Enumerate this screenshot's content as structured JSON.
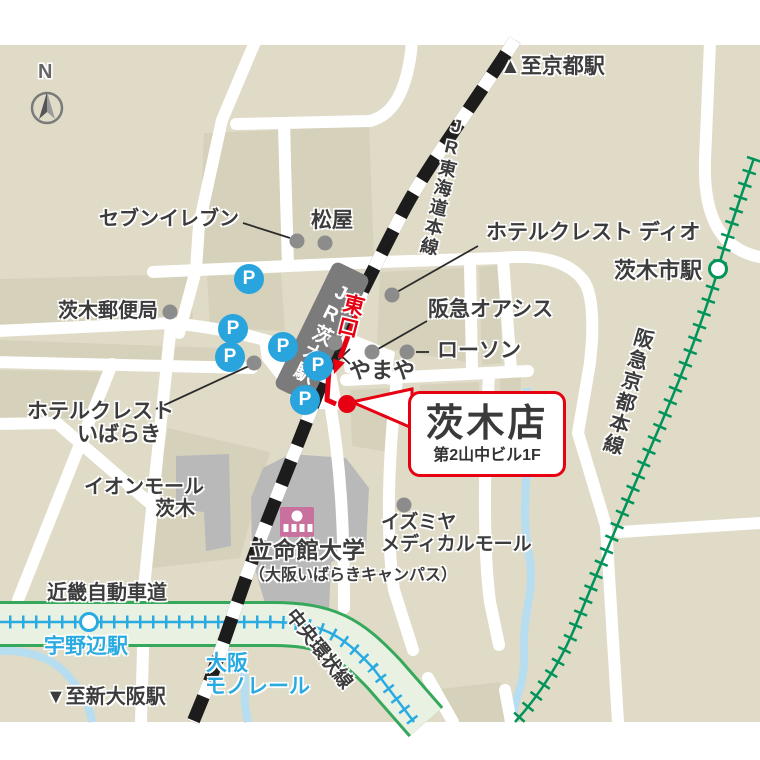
{
  "store": {
    "name": "茨木店",
    "building": "第2山中ビル1F"
  },
  "station": {
    "jr_label": "JR茨木駅",
    "east_exit": "東口"
  },
  "compass": {
    "north_label": "N"
  },
  "colors": {
    "accent_red": "#e60012",
    "parking_blue": "#29a4dd",
    "monorail_cyan": "#29abe2",
    "hankyu_green": "#00935a",
    "expressway_green": "#35a85b",
    "jr_rail_black": "#1c1c1c",
    "road_white": "#ffffff",
    "map_base": "#dfdbc7",
    "map_block": "#d5d1ba",
    "building_gray": "#b9b9b9",
    "university_pink": "#c9719e"
  },
  "map": {
    "parking_letter": "P",
    "parking": [
      {
        "x": 249,
        "y": 279
      },
      {
        "x": 233,
        "y": 329
      },
      {
        "x": 230,
        "y": 357
      },
      {
        "x": 283,
        "y": 347
      },
      {
        "x": 318,
        "y": 366
      },
      {
        "x": 305,
        "y": 400
      }
    ],
    "poi_dots": [
      {
        "name": "seven-eleven-dot",
        "x": 297,
        "y": 241
      },
      {
        "name": "matsuya-dot",
        "x": 325,
        "y": 243
      },
      {
        "name": "post-office-dot",
        "x": 170,
        "y": 312
      },
      {
        "name": "hotel-crest-dio-dot",
        "x": 392,
        "y": 295
      },
      {
        "name": "hankyu-oasis-dot",
        "x": 372,
        "y": 352
      },
      {
        "name": "lawson-dot",
        "x": 407,
        "y": 352
      },
      {
        "name": "yamaya-dot",
        "x": 335,
        "y": 343
      },
      {
        "name": "hotel-crest-ibaraki-dot",
        "x": 254,
        "y": 363
      },
      {
        "name": "izumiya-dot",
        "x": 404,
        "y": 505
      }
    ],
    "station_circles": [
      {
        "name": "ibarakishi-station-circle",
        "x": 718,
        "y": 269,
        "color": "#00935a"
      },
      {
        "name": "unobe-station-circle",
        "x": 89,
        "y": 622,
        "color": "#29abe2"
      }
    ],
    "labels": [
      {
        "id": "to-kyoto",
        "text": "▲至京都駅",
        "x": 500,
        "y": 56,
        "size": 21
      },
      {
        "id": "seven-eleven",
        "text": "セブンイレブン",
        "x": 99,
        "y": 209,
        "size": 20
      },
      {
        "id": "matsuya",
        "text": "松屋",
        "x": 311,
        "y": 210,
        "size": 21
      },
      {
        "id": "hotel-crest-dio",
        "text": "ホテルクレスト ディオ",
        "x": 486,
        "y": 222,
        "size": 21
      },
      {
        "id": "ibarakishi-station",
        "text": "茨木市駅",
        "x": 614,
        "y": 259,
        "size": 22
      },
      {
        "id": "hankyu-oasis",
        "text": "阪急オアシス",
        "x": 428,
        "y": 299,
        "size": 21
      },
      {
        "id": "lawson",
        "text": "ローソン",
        "x": 437,
        "y": 340,
        "size": 21
      },
      {
        "id": "yamaya",
        "text": "やまや",
        "x": 349,
        "y": 359,
        "size": 22
      },
      {
        "id": "post-office",
        "text": "茨木郵便局",
        "x": 58,
        "y": 301,
        "size": 20
      },
      {
        "id": "hotel-crest-ibaraki-1",
        "text": "ホテルクレスト",
        "x": 27,
        "y": 401,
        "size": 21
      },
      {
        "id": "hotel-crest-ibaraki-2",
        "text": "いばらき",
        "x": 77,
        "y": 424,
        "size": 21
      },
      {
        "id": "aeon-mall-1",
        "text": "イオンモール",
        "x": 84,
        "y": 477,
        "size": 20
      },
      {
        "id": "aeon-mall-2",
        "text": "茨木",
        "x": 155,
        "y": 499,
        "size": 20
      },
      {
        "id": "ritsumeikan",
        "text": "立命館大学",
        "x": 250,
        "y": 538,
        "size": 23
      },
      {
        "id": "ritsumeikan-campus",
        "text": "（大阪いばらきキャンパス）",
        "x": 249,
        "y": 568,
        "size": 16
      },
      {
        "id": "izumiya-1",
        "text": "イズミヤ",
        "x": 381,
        "y": 513,
        "size": 19
      },
      {
        "id": "izumiya-2",
        "text": "メディカルモール",
        "x": 381,
        "y": 535,
        "size": 19
      },
      {
        "id": "kinki-expressway",
        "text": "近畿自動車道",
        "x": 47,
        "y": 583,
        "size": 20
      },
      {
        "id": "unobe-station",
        "text": "宇野辺駅",
        "x": 44,
        "y": 636,
        "size": 21,
        "color": "#29abe2"
      },
      {
        "id": "osaka-monorail-1",
        "text": "大阪",
        "x": 206,
        "y": 653,
        "size": 21,
        "color": "#29abe2"
      },
      {
        "id": "osaka-monorail-2",
        "text": "モノレール",
        "x": 205,
        "y": 676,
        "size": 21,
        "color": "#29abe2"
      },
      {
        "id": "to-shin-osaka",
        "text": "▼至新大阪駅",
        "x": 46,
        "y": 687,
        "size": 20
      },
      {
        "id": "chuo-kanjo-line",
        "text": "中央環状線",
        "x": 297,
        "y": 606,
        "size": 19,
        "rotate": 52
      },
      {
        "id": "hankyu-kyoto-line",
        "text": "阪急京都本線",
        "x": 634,
        "y": 325,
        "size": 20,
        "vertical": true,
        "rotate": 16
      },
      {
        "id": "jr-tokaido-line",
        "text": "JR東海道本線",
        "x": 449,
        "y": 114,
        "size": 18,
        "vertical": true,
        "rotate": 13
      },
      {
        "id": "higashiguchi-east-exit",
        "text": "東口",
        "x": 344,
        "y": 291,
        "size": 21,
        "vertical": true,
        "rotate": 14,
        "color": "#e60012",
        "bold": true
      },
      {
        "id": "compass-n",
        "text": "N",
        "x": 38,
        "y": 62,
        "size": 20,
        "bold": true,
        "color": "#666666"
      }
    ]
  }
}
